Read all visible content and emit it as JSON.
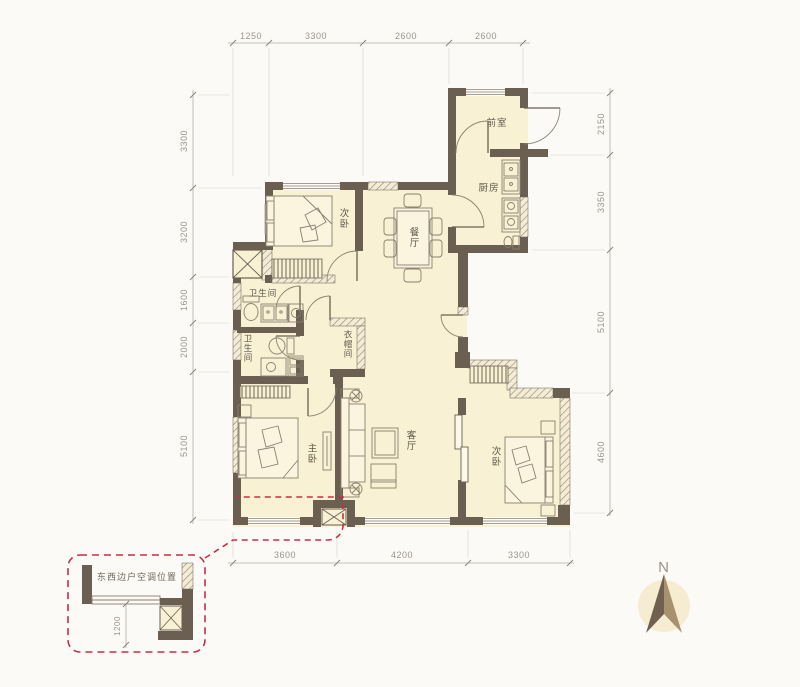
{
  "dimensions": {
    "top": [
      "1250",
      "3300",
      "2600",
      "2600"
    ],
    "left": [
      "3300",
      "3200",
      "1600",
      "2000",
      "5100"
    ],
    "right": [
      "2150",
      "3350",
      "5100",
      "4600"
    ],
    "bottom": [
      "3600",
      "4200",
      "3300"
    ]
  },
  "rooms": {
    "entry": {
      "label": "前室"
    },
    "kitchen": {
      "label": "厨房"
    },
    "bedroom_top": {
      "label": "次卧"
    },
    "dining": {
      "label": "餐厅"
    },
    "bathroom_upper": {
      "label": "卫生间"
    },
    "bathroom_lower": {
      "label": "卫生间"
    },
    "cloakroom": {
      "label": "衣帽间"
    },
    "living": {
      "label": "客厅"
    },
    "master": {
      "label": "主卧"
    },
    "bedroom_right": {
      "label": "次卧"
    }
  },
  "annotation": {
    "ac_note": "东西边户空调位置",
    "ac_depth": "1200"
  },
  "compass": {
    "north": "N"
  },
  "colors": {
    "wall": "#6b5f51",
    "room_fill": "#f8f1d3",
    "annotation_red": "#c23048",
    "dim_text": "#9b968c"
  }
}
